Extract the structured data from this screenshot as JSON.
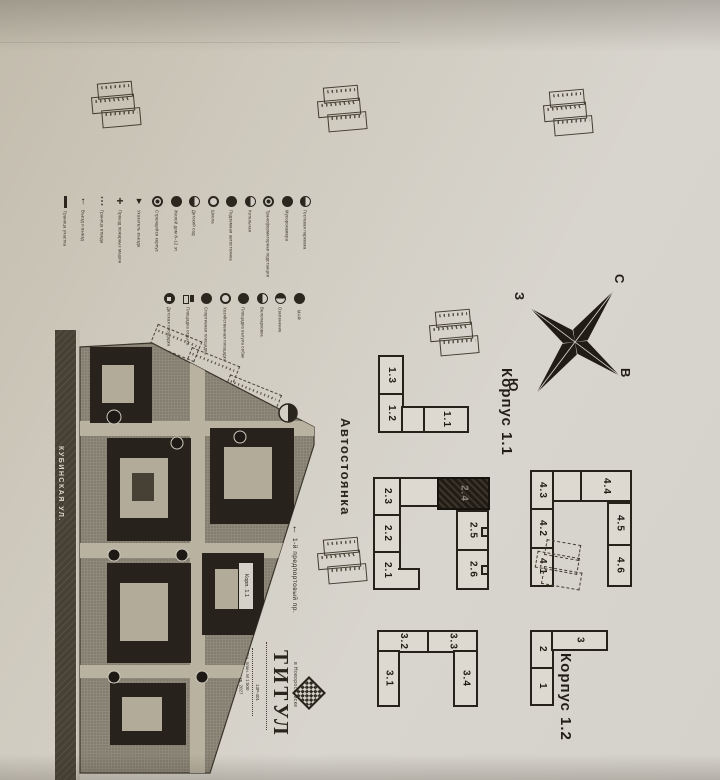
{
  "compass": {
    "north": "С",
    "south": "Ю",
    "west": "З",
    "east": "В"
  },
  "labels": {
    "korpus11": "Корпус 1.1",
    "korpus12": "Корпус 1.2",
    "parking": "Автостоянка"
  },
  "plan": {
    "street_main": "КУБИНСКАЯ УЛ.",
    "street_side": "1-й предпортовый пр.",
    "street_arrow": "↑",
    "callout": "Корп. 1.1"
  },
  "schemes": {
    "g1": {
      "units": [
        "1.3",
        "1.2",
        "1.1"
      ]
    },
    "g2": {
      "units": [
        "2.3",
        "2.2",
        "2.1",
        "2.5",
        "2.6"
      ],
      "dark_unit": "2.4"
    },
    "g4": {
      "units": [
        "4.3",
        "4.2",
        "4.1",
        "4.4",
        "4.5",
        "4.6"
      ]
    },
    "g3": {
      "units": [
        "3.2",
        "3.3",
        "3.1",
        "3.4"
      ]
    },
    "g12": {
      "units": [
        "2",
        "1",
        "3"
      ]
    }
  },
  "legend": {
    "row1": [
      {
        "icon": "boundary-line",
        "label": "Граница участка"
      },
      {
        "icon": "entry-arrow",
        "label": "Въезд и выезд"
      },
      {
        "icon": "dashed-line",
        "label": "Граница отвода"
      },
      {
        "icon": "cross-mark",
        "label": "Проезд пожарных машин"
      },
      {
        "icon": "triangle-marker",
        "label": "Указатель въезда"
      },
      {
        "icon": "circle-dot",
        "label": "Строящийся корпус"
      },
      {
        "icon": "circle-filled",
        "label": "Жилой дом 8–12 эт."
      },
      {
        "icon": "circle-half",
        "label": "Детский сад"
      },
      {
        "icon": "circle-ring",
        "label": "Школа"
      },
      {
        "icon": "circle-filled",
        "label": "Подземная автостоянка"
      },
      {
        "icon": "circle-half",
        "label": "Котельная"
      },
      {
        "icon": "circle-dot",
        "label": "Трансформаторная подстанция"
      },
      {
        "icon": "circle-filled",
        "label": "Мусорокамера"
      },
      {
        "icon": "circle-half",
        "label": "Гостевая парковка"
      }
    ],
    "row2": [
      {
        "icon": "circle-square",
        "label": "Детская площадка"
      },
      {
        "icon": "square-pair",
        "label": "Площадка отдыха"
      },
      {
        "icon": "circle-filled",
        "label": "Спортивная площадка"
      },
      {
        "icon": "circle-ring",
        "label": "Хозяйственная площадка"
      },
      {
        "icon": "circle-filled",
        "label": "Площадка выгула собак"
      },
      {
        "icon": "circle-half",
        "label": "Велопарковка"
      },
      {
        "icon": "circle-half-v",
        "label": "Озеленение"
      },
      {
        "icon": "circle-filled",
        "label": "МАФ"
      }
    ]
  },
  "title_block": {
    "brand": "ТИТУЛ",
    "city": "в Новороссийске",
    "note1": "Ген. план. М 1:500",
    "note2": "Сдача — IV кв. 2027",
    "code": "13Р-401"
  }
}
